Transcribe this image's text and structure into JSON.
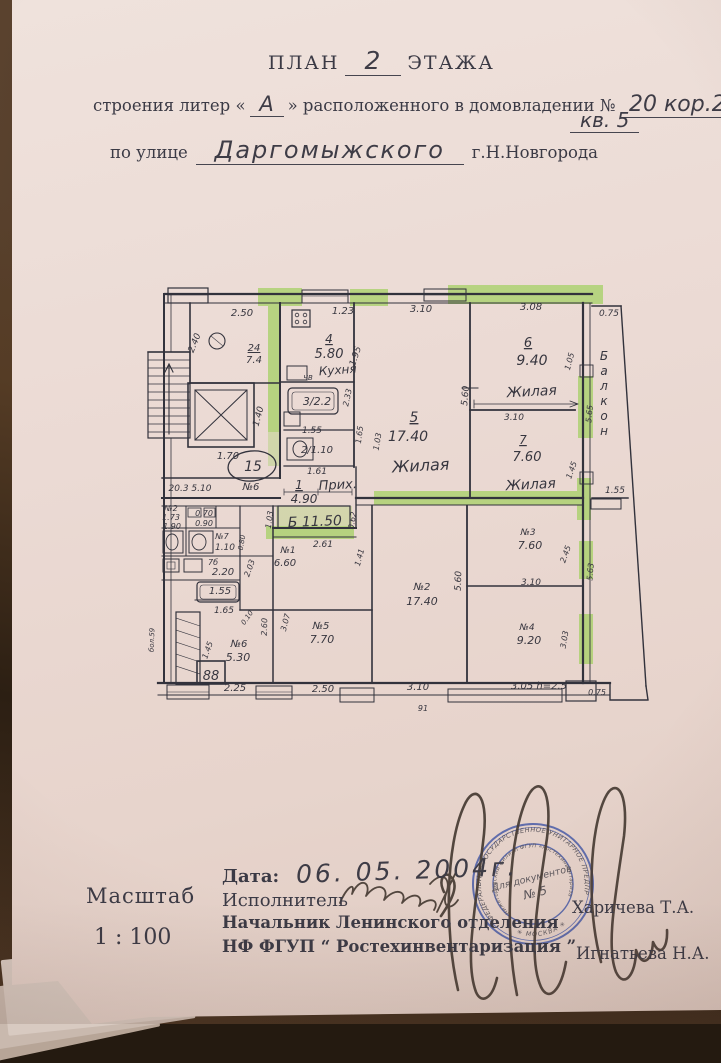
{
  "header": {
    "plan_label": "ПЛАН",
    "plan_number": "2",
    "floor_label": "ЭТАЖА",
    "line2_prefix": "строения литер «",
    "liter": "А",
    "line2_middle": "» расположенного в домовладении №",
    "house_number": "20 кор.2",
    "apartment": "кв. 5",
    "line3_prefix": "по улице",
    "street": "Даргомыжского",
    "city": "г.Н.Новгорода"
  },
  "plan": {
    "labels": [
      {
        "t": "2.50",
        "x": 242,
        "y": 316
      },
      {
        "t": "1.23",
        "x": 343,
        "y": 314
      },
      {
        "t": "3.10",
        "x": 421,
        "y": 312
      },
      {
        "t": "3.08",
        "x": 531,
        "y": 310
      },
      {
        "t": "0.75",
        "x": 609,
        "y": 316,
        "s": 9
      },
      {
        "t": "2.40",
        "x": 197,
        "y": 344,
        "r": -68,
        "s": 9
      },
      {
        "t": "24",
        "x": 254,
        "y": 351,
        "u": 1
      },
      {
        "t": "7.4",
        "x": 254,
        "y": 363
      },
      {
        "t": "1.40",
        "x": 261,
        "y": 417,
        "r": -75,
        "s": 9
      },
      {
        "t": "1.70",
        "x": 228,
        "y": 459
      },
      {
        "t": "15",
        "x": 253,
        "y": 471,
        "s": 14
      },
      {
        "t": "№6",
        "x": 251,
        "y": 490
      },
      {
        "t": "20.3 5.10",
        "x": 190,
        "y": 491,
        "s": 9
      },
      {
        "t": "4",
        "x": 329,
        "y": 343,
        "u": 1,
        "s": 12
      },
      {
        "t": "5.80",
        "x": 329,
        "y": 358,
        "s": 13
      },
      {
        "t": "Кухня",
        "x": 338,
        "y": 374,
        "r": -4,
        "s": 12
      },
      {
        "t": "ЧВ",
        "x": 308,
        "y": 380,
        "s": 7
      },
      {
        "t": "1.95",
        "x": 358,
        "y": 357,
        "r": -72,
        "s": 9
      },
      {
        "t": "3/2.2",
        "x": 317,
        "y": 405,
        "s": 11
      },
      {
        "t": "1.55",
        "x": 312,
        "y": 433,
        "s": 9
      },
      {
        "t": "2/1.10",
        "x": 317,
        "y": 453
      },
      {
        "t": "1.61",
        "x": 317,
        "y": 474,
        "s": 9
      },
      {
        "t": "2.33",
        "x": 350,
        "y": 398,
        "r": -78,
        "s": 8
      },
      {
        "t": "1.65",
        "x": 362,
        "y": 435,
        "r": -83,
        "s": 8
      },
      {
        "t": "1.03",
        "x": 380,
        "y": 442,
        "r": -80,
        "s": 8
      },
      {
        "t": "1",
        "x": 299,
        "y": 489,
        "u": 1,
        "s": 12
      },
      {
        "t": "Прих.",
        "x": 338,
        "y": 489,
        "r": -3,
        "s": 13
      },
      {
        "t": "4.90",
        "x": 304,
        "y": 503,
        "s": 12
      },
      {
        "t": "Б 11.50",
        "x": 315,
        "y": 526,
        "r": -2,
        "s": 14
      },
      {
        "t": "2.61",
        "x": 323,
        "y": 547,
        "s": 9
      },
      {
        "t": "1.03",
        "x": 272,
        "y": 520,
        "r": -82,
        "s": 8
      },
      {
        "t": "0.62",
        "x": 355,
        "y": 521,
        "r": -80,
        "s": 8
      },
      {
        "t": "5",
        "x": 414,
        "y": 422,
        "u": 1,
        "s": 14
      },
      {
        "t": "17.40",
        "x": 408,
        "y": 441,
        "s": 14
      },
      {
        "t": "Жилая",
        "x": 421,
        "y": 471,
        "r": -3,
        "s": 16
      },
      {
        "t": "6",
        "x": 528,
        "y": 347,
        "u": 1,
        "s": 13
      },
      {
        "t": "9.40",
        "x": 532,
        "y": 365,
        "s": 14
      },
      {
        "t": "Жилая",
        "x": 532,
        "y": 396,
        "r": -3,
        "s": 14
      },
      {
        "t": "7",
        "x": 523,
        "y": 444,
        "u": 1,
        "s": 12
      },
      {
        "t": "7.60",
        "x": 527,
        "y": 461,
        "s": 13
      },
      {
        "t": "Жилая",
        "x": 531,
        "y": 489,
        "r": -3,
        "s": 14
      },
      {
        "t": "3.10",
        "x": 514,
        "y": 420,
        "s": 9
      },
      {
        "t": "5.60",
        "x": 468,
        "y": 396,
        "r": -85,
        "s": 9
      },
      {
        "t": "1.05",
        "x": 572,
        "y": 362,
        "r": -75,
        "s": 8
      },
      {
        "t": "5.65",
        "x": 592,
        "y": 414,
        "r": -85,
        "s": 8
      },
      {
        "t": "1.45",
        "x": 574,
        "y": 471,
        "r": -70,
        "s": 8
      },
      {
        "t": "Балкон",
        "x": 604,
        "y": 360,
        "s": 12,
        "v": 15
      },
      {
        "t": "1.55",
        "x": 615,
        "y": 493,
        "s": 9
      },
      {
        "t": "№3",
        "x": 528,
        "y": 535,
        "s": 9
      },
      {
        "t": "7.60",
        "x": 530,
        "y": 549,
        "s": 11
      },
      {
        "t": "3.10",
        "x": 531,
        "y": 585,
        "s": 9
      },
      {
        "t": "№4",
        "x": 527,
        "y": 630,
        "s": 9
      },
      {
        "t": "9.20",
        "x": 529,
        "y": 644,
        "s": 11
      },
      {
        "t": "2.45",
        "x": 568,
        "y": 555,
        "r": -70,
        "s": 8
      },
      {
        "t": "5.63",
        "x": 593,
        "y": 572,
        "r": -85,
        "s": 8
      },
      {
        "t": "3.03",
        "x": 567,
        "y": 640,
        "r": -80,
        "s": 8
      },
      {
        "t": "5.60",
        "x": 461,
        "y": 581,
        "r": -88,
        "s": 9
      },
      {
        "t": "№2",
        "x": 422,
        "y": 590
      },
      {
        "t": "17.40",
        "x": 422,
        "y": 605,
        "s": 11
      },
      {
        "t": "1.41",
        "x": 362,
        "y": 558,
        "r": -75,
        "s": 8
      },
      {
        "t": "№1",
        "x": 288,
        "y": 553,
        "s": 9
      },
      {
        "t": "6.60",
        "x": 285,
        "y": 566
      },
      {
        "t": "№5",
        "x": 321,
        "y": 629
      },
      {
        "t": "7.70",
        "x": 322,
        "y": 643,
        "s": 11
      },
      {
        "t": "3.07",
        "x": 288,
        "y": 623,
        "r": -75,
        "s": 8
      },
      {
        "t": "2.60",
        "x": 267,
        "y": 627,
        "r": -88,
        "s": 8
      },
      {
        "t": "№6",
        "x": 239,
        "y": 647
      },
      {
        "t": "5.30",
        "x": 238,
        "y": 661,
        "s": 11
      },
      {
        "t": "1.45",
        "x": 210,
        "y": 651,
        "r": -70,
        "s": 8
      },
      {
        "t": "1.65",
        "x": 224,
        "y": 613,
        "s": 9
      },
      {
        "t": "0.10",
        "x": 249,
        "y": 619,
        "r": -55,
        "s": 7
      },
      {
        "t": "88",
        "x": 211,
        "y": 680,
        "s": 13
      },
      {
        "t": "2.25",
        "x": 235,
        "y": 691
      },
      {
        "t": "2.50",
        "x": 323,
        "y": 692
      },
      {
        "t": "3.10",
        "x": 418,
        "y": 690
      },
      {
        "t": "3.05 h=2.5",
        "x": 539,
        "y": 689
      },
      {
        "t": "0.75",
        "x": 597,
        "y": 695,
        "s": 8
      },
      {
        "t": "91",
        "x": 423,
        "y": 711,
        "s": 8
      },
      {
        "t": "№2",
        "x": 171,
        "y": 511,
        "s": 8
      },
      {
        "t": "1.73",
        "x": 171,
        "y": 520,
        "s": 8
      },
      {
        "t": "1.90",
        "x": 172,
        "y": 529,
        "s": 8
      },
      {
        "t": "0.70",
        "x": 204,
        "y": 516,
        "s": 8
      },
      {
        "t": "0.90",
        "x": 204,
        "y": 526,
        "s": 8
      },
      {
        "t": "№7",
        "x": 222,
        "y": 539,
        "s": 8
      },
      {
        "t": "1.10",
        "x": 225,
        "y": 550,
        "s": 9
      },
      {
        "t": "0.80",
        "x": 244,
        "y": 543,
        "r": -80,
        "s": 7
      },
      {
        "t": "7б",
        "x": 213,
        "y": 565,
        "s": 8
      },
      {
        "t": "2.20",
        "x": 223,
        "y": 575
      },
      {
        "t": "2.03",
        "x": 252,
        "y": 569,
        "r": -70,
        "s": 8
      },
      {
        "t": "1.55",
        "x": 220,
        "y": 594
      },
      {
        "t": "бол.59",
        "x": 154,
        "y": 640,
        "r": -88,
        "s": 7
      }
    ]
  },
  "stamp": {
    "ring_outer": "ФЕДЕРАЛЬНОЕ ГОСУДАРСТВЕННОЕ УНИТАРНОЕ ПРЕДПРИЯТИЕ",
    "ring_inner": "Нижегородский филиал ФГУП «Ростехинвентаризация»",
    "bottom": "✳ МОСКВА ✳",
    "center_line1": "Для документов",
    "center_line2": "№ 5",
    "color": "#3b51a4"
  },
  "footer": {
    "scale_label": "Масштаб",
    "scale_value": "1 : 100",
    "date_label": "Дата:",
    "date_value": "06. 05. 2004г.",
    "executor_label": "Исполнитель",
    "chief_label": "Начальник Ленинского отделения",
    "org_label": "НФ ФГУП “ Ростехинвентаризация ”",
    "signature1_name": "Харичева Т.А.",
    "signature2_name": "Игнатьева Н.А."
  },
  "colors": {
    "highlight": "#97cf4e",
    "ink": "#37363f",
    "stamp_blue": "#3b51a4",
    "paper": "#e9d8d2"
  }
}
